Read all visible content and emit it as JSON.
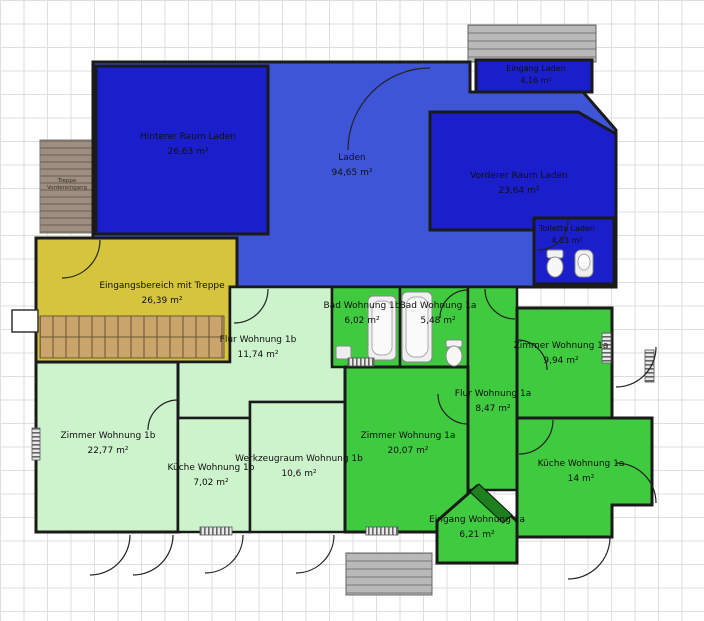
{
  "app": {
    "view": "floor-plan"
  },
  "palette": {
    "room_dark_blue": "#1b1ecb",
    "room_blue": "#3f55d8",
    "room_yellow": "#d6c53c",
    "room_pale_green": "#ccf3cc",
    "room_green": "#3fca3f",
    "door_leaf_green": "#1d7f1d",
    "wall": "#1a1a1a"
  },
  "rooms": [
    {
      "id": "hinterer-raum-laden",
      "name": "Hinterer Raum Laden",
      "area": "26,63 m²"
    },
    {
      "id": "laden",
      "name": "Laden",
      "area": "94,65 m²"
    },
    {
      "id": "eingang-laden",
      "name": "Eingang Laden",
      "area": "4,16 m²"
    },
    {
      "id": "vorderer-raum-laden",
      "name": "Vorderer Raum Laden",
      "area": "23,64 m²"
    },
    {
      "id": "toilette-laden",
      "name": "Toilette Laden",
      "area": "4,03 m²"
    },
    {
      "id": "eingangsbereich-mit-treppe",
      "name": "Eingangsbereich mit Treppe",
      "area": "26,39 m²"
    },
    {
      "id": "flur-wohnung-1b",
      "name": "Flur Wohnung 1b",
      "area": "11,74 m²"
    },
    {
      "id": "bad-wohnung-1b",
      "name": "Bad Wohnung 1b",
      "area": "6,02 m²"
    },
    {
      "id": "bad-wohnung-1a",
      "name": "Bad Wohnung 1a",
      "area": "5,48 m²"
    },
    {
      "id": "zimmer-wohnung-1a-klein",
      "name": "Zimmer Wohnung 1a",
      "area": "9,94 m²"
    },
    {
      "id": "flur-wohnung-1a",
      "name": "Flur Wohnung 1a",
      "area": "8,47 m²"
    },
    {
      "id": "zimmer-wohnung-1b",
      "name": "Zimmer Wohnung 1b",
      "area": "22,77 m²"
    },
    {
      "id": "kueche-wohnung-1b",
      "name": "Küche Wohnung 1b",
      "area": "7,02 m²"
    },
    {
      "id": "werkzeugraum-wohnung-1b",
      "name": "Werkzeugraum Wohnung 1b",
      "area": "10,6 m²"
    },
    {
      "id": "zimmer-wohnung-1a-gross",
      "name": "Zimmer Wohnung 1a",
      "area": "20,07 m²"
    },
    {
      "id": "kueche-wohnung-1a",
      "name": "Küche Wohnung 1a",
      "area": "14 m²"
    },
    {
      "id": "eingang-wohnung-1a",
      "name": "Eingang Wohnung 1a",
      "area": "6,21 m²"
    }
  ],
  "outdoor": {
    "treppe_vordereingang": {
      "label": "Treppe Vordereingang"
    }
  },
  "fixtures": [
    "toilet",
    "washbasin",
    "bathtub",
    "sink",
    "radiator",
    "stairs"
  ]
}
